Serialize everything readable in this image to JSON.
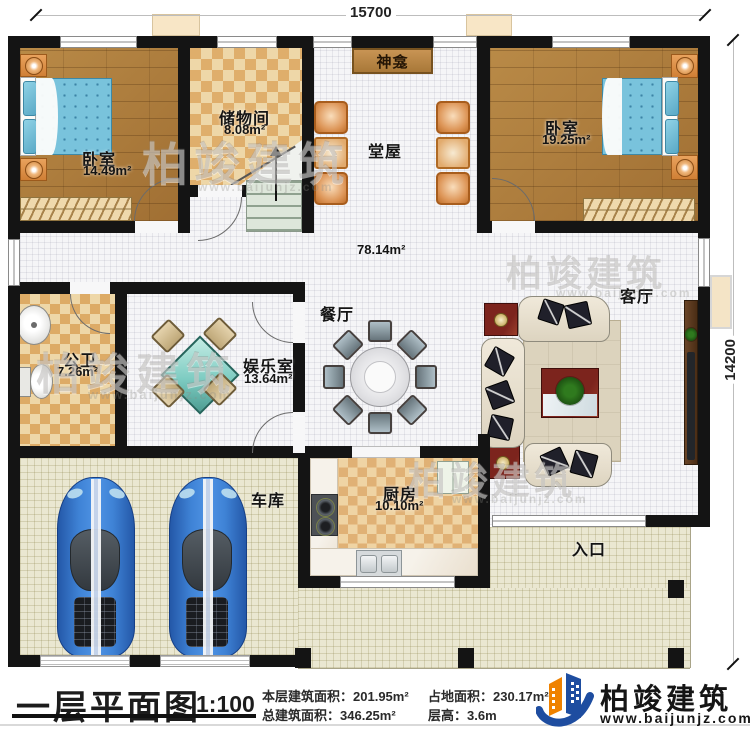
{
  "dimensions": {
    "top": "15700",
    "right": "14200"
  },
  "rooms": {
    "bedroom1": {
      "label": "卧室",
      "area": "14.49m²"
    },
    "storage": {
      "label": "储物间",
      "area": "8.08m²"
    },
    "shrine": {
      "label": "神龛"
    },
    "hall": {
      "label": "堂屋",
      "area": "78.14m²"
    },
    "bedroom2": {
      "label": "卧室",
      "area": "19.25m²"
    },
    "bathroom": {
      "label": "公卫",
      "area": "7.26m²"
    },
    "gameroom": {
      "label": "娱乐室",
      "area": "13.64m²"
    },
    "dining": {
      "label": "餐厅"
    },
    "living": {
      "label": "客厅"
    },
    "garage": {
      "label": "车库"
    },
    "kitchen": {
      "label": "厨房",
      "area": "10.10m²"
    },
    "entrance": {
      "label": "入口"
    }
  },
  "titleblock": {
    "plan_title": "一层平面图",
    "scale": "1:100",
    "stats": {
      "floor_area_label": "本层建筑面积：",
      "floor_area_value": "201.95m²",
      "land_area_label": "占地面积：",
      "land_area_value": "230.17m²",
      "total_area_label": "总建筑面积：",
      "total_area_value": "346.25m²",
      "floor_height_label": "层高：",
      "floor_height_value": "3.6m"
    }
  },
  "brand": {
    "name": "柏竣建筑",
    "url": "www.baijunjz.com"
  },
  "watermark": {
    "name": "柏竣建筑",
    "url": "www.baijunjz.com"
  },
  "colors": {
    "wall": "#141414",
    "wood_floor": "#ab7b3c",
    "tile_light": "#eed7a8",
    "tile_dark": "#dfae6b",
    "brand_blue": "#1e4da0",
    "brand_orange": "#ef8200"
  }
}
